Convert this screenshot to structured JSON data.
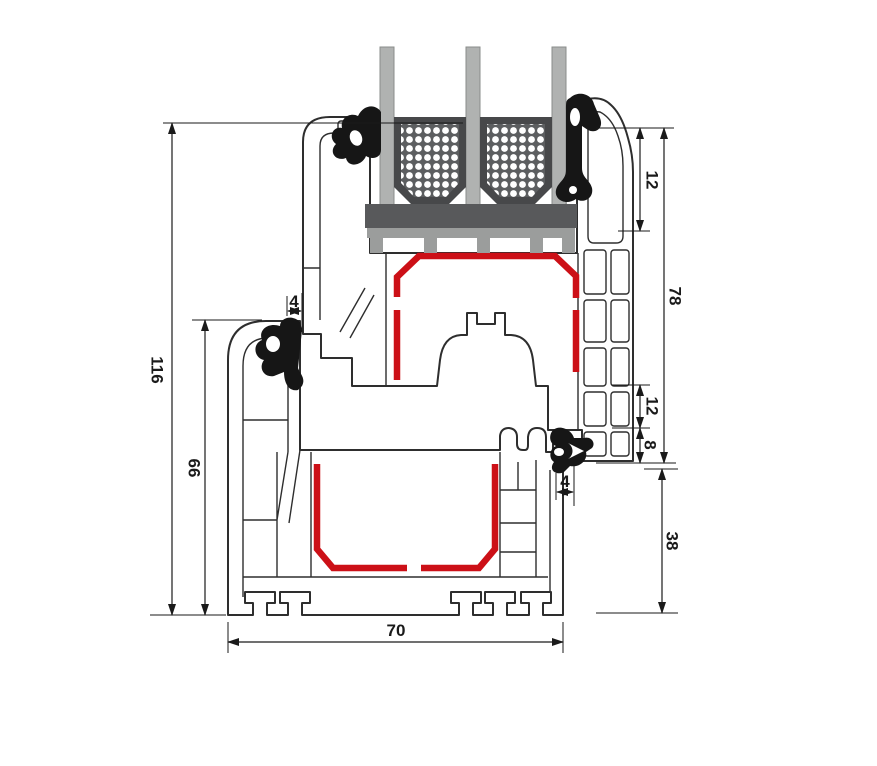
{
  "diagram": {
    "kind": "window-profile-cross-section-technical-drawing",
    "dims": {
      "total_height": "116",
      "frame_height": "66",
      "profile_depth": "70",
      "sash_height": "78",
      "glass_edge_cover": "12",
      "rebate_upper": "12",
      "rebate_lower": "8",
      "seal_gap_left": "4",
      "seal_gap_right": "4",
      "frame_face_below_sash": "38"
    },
    "colors": {
      "steel_reinforcement_red": "#cc1017",
      "glass_gray": "#b0b2b1",
      "spacer_dark": "#47484a",
      "spacer_inner": "#5c5e60",
      "setting_block_dark": "#58595b",
      "bridge_gray": "#9b9d9c",
      "gasket_black": "#161616",
      "profile_outline": "#2e2e2e",
      "dimension_line": "#1a1a1a"
    }
  }
}
